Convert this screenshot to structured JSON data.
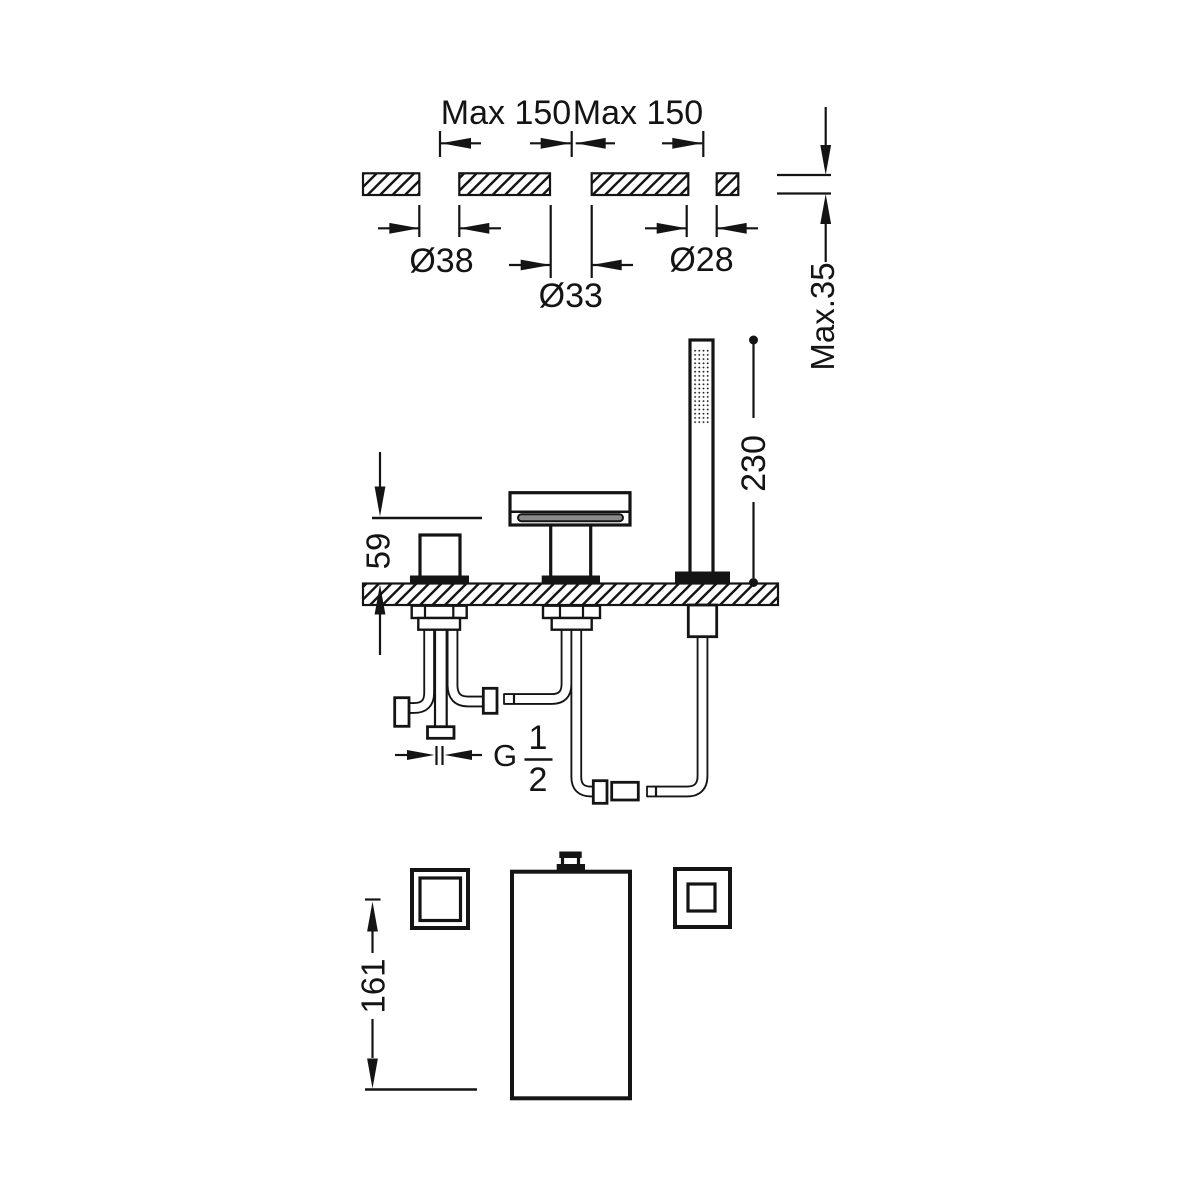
{
  "colors": {
    "line": "#141414",
    "background": "#ffffff",
    "spout_slot_gray": "#8a8a8a"
  },
  "top_view": {
    "dim_spacing_left": "Max 150",
    "dim_spacing_right": "Max 150",
    "dim_hole_left_diameter": "Ø38",
    "dim_hole_center_diameter": "Ø33",
    "dim_hole_right_diameter": "Ø28",
    "dim_deck_thickness": "Max.35"
  },
  "side_view": {
    "dim_outlet_height": "59",
    "dim_handshower_height": "230",
    "thread_label": {
      "prefix": "G",
      "numerator": "1",
      "denominator": "2"
    }
  },
  "plan_view": {
    "dim_spout_length": "161"
  }
}
